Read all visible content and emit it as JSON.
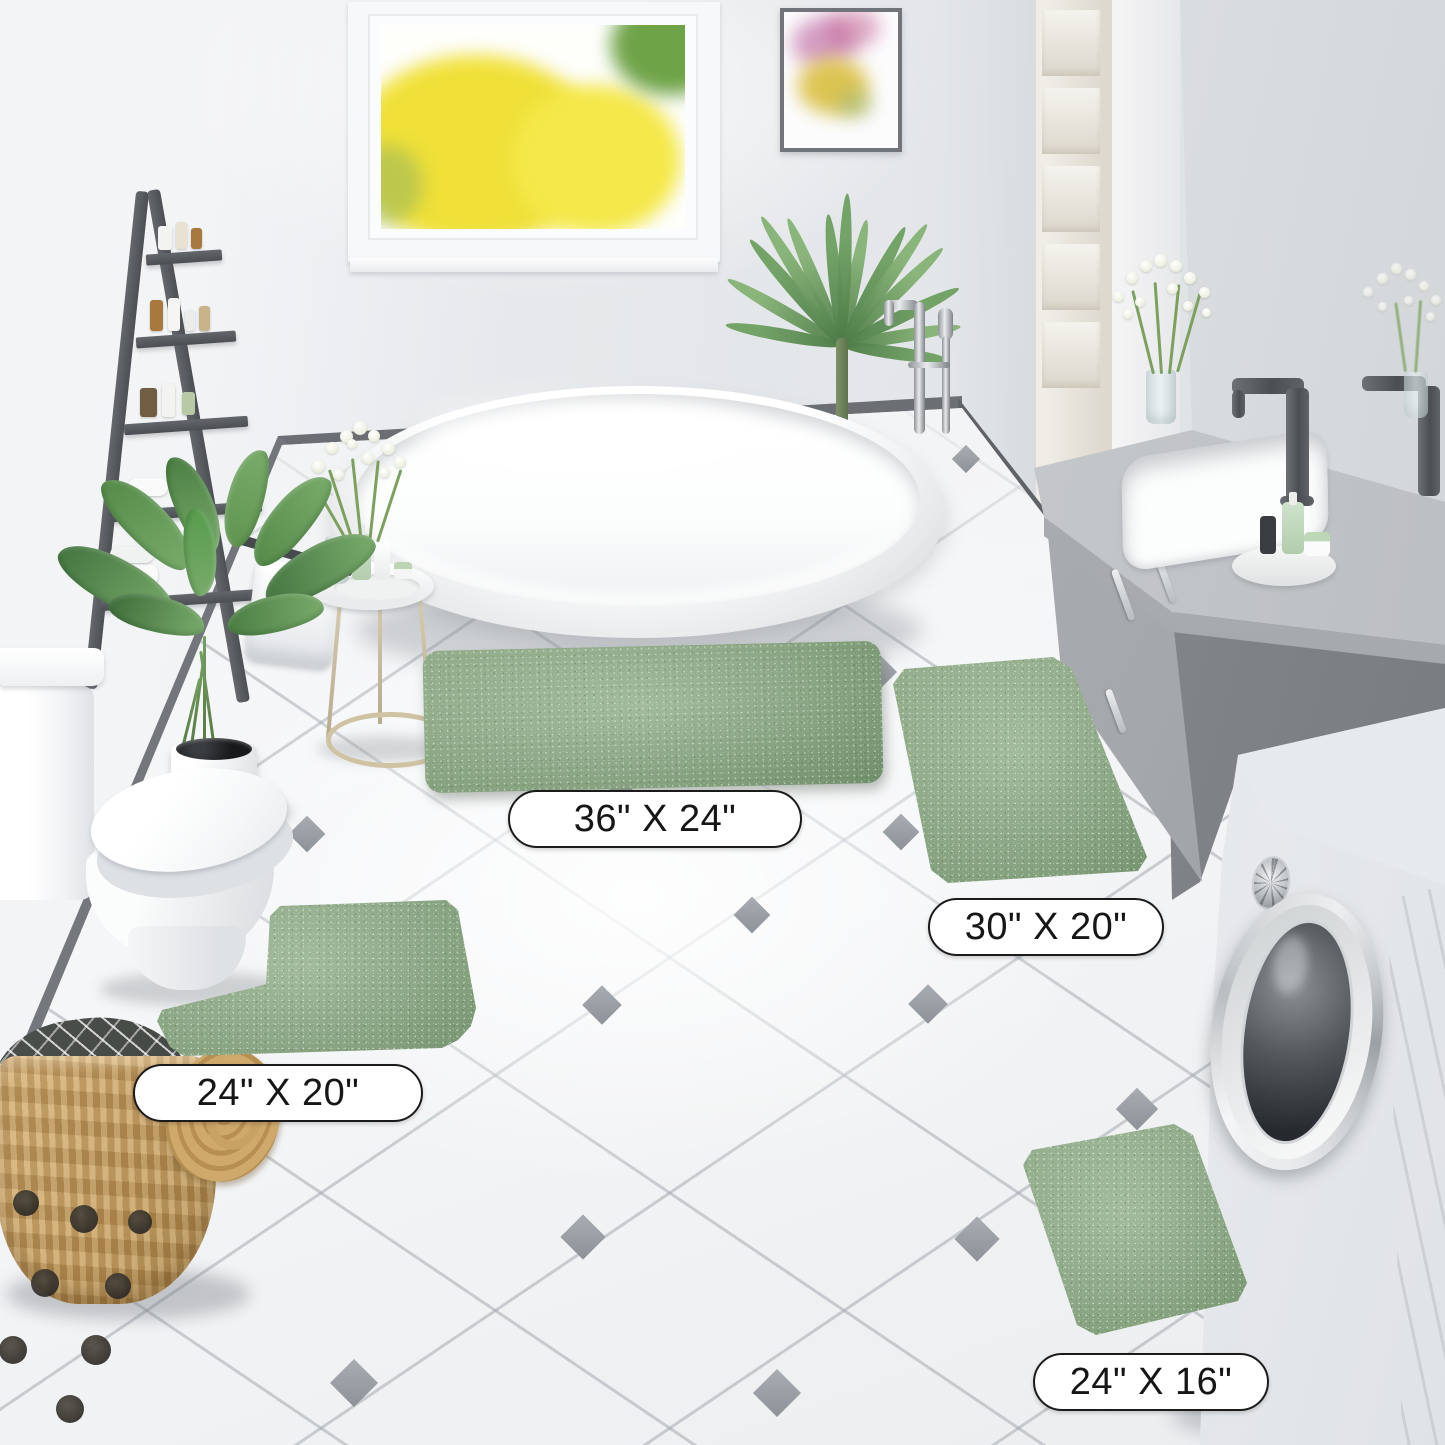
{
  "image_type": "product-photo",
  "scene_description": "Bright bathroom scene displaying a four-piece sage green chenille bath rug set on white diamond-accent tile, with freestanding tub, vanity, toilet and washing machine",
  "labels": [
    {
      "id": "rug-36x24",
      "text": "36\" X 24\""
    },
    {
      "id": "rug-30x20",
      "text": "30\" X 20\""
    },
    {
      "id": "rug-24x20",
      "text": "24\" X 20\""
    },
    {
      "id": "rug-24x16",
      "text": "24\" X 16\""
    }
  ],
  "colors": {
    "rug_green": "#8dab85",
    "wall_gray": "#e8eaec",
    "floor_white": "#f4f5f7",
    "tile_accent_gray": "#9aa0a6",
    "skirting_gray": "#5f6368",
    "vanity_gray": "#a4a8ac",
    "ladder_gray": "#55585c",
    "basket_tan": "#c9a369",
    "window_foliage_yellow": "#f0e135",
    "plant_green": "#548a49"
  },
  "objects": [
    "freestanding oval bathtub",
    "chrome floor-mounted tub faucet",
    "window with yellow autumn trees",
    "framed watercolor artwork",
    "dark gray ladder shelf with toiletries and towels",
    "potted green plant",
    "areca palm",
    "round side table with vase of white flowers and toiletries",
    "white toilet",
    "wicker basket with patterned towel and lid",
    "gray vanity with inset sink, dark faucet and mirror",
    "front-loading washing machine",
    "contour bath rug",
    "three rectangular bath rugs"
  ]
}
